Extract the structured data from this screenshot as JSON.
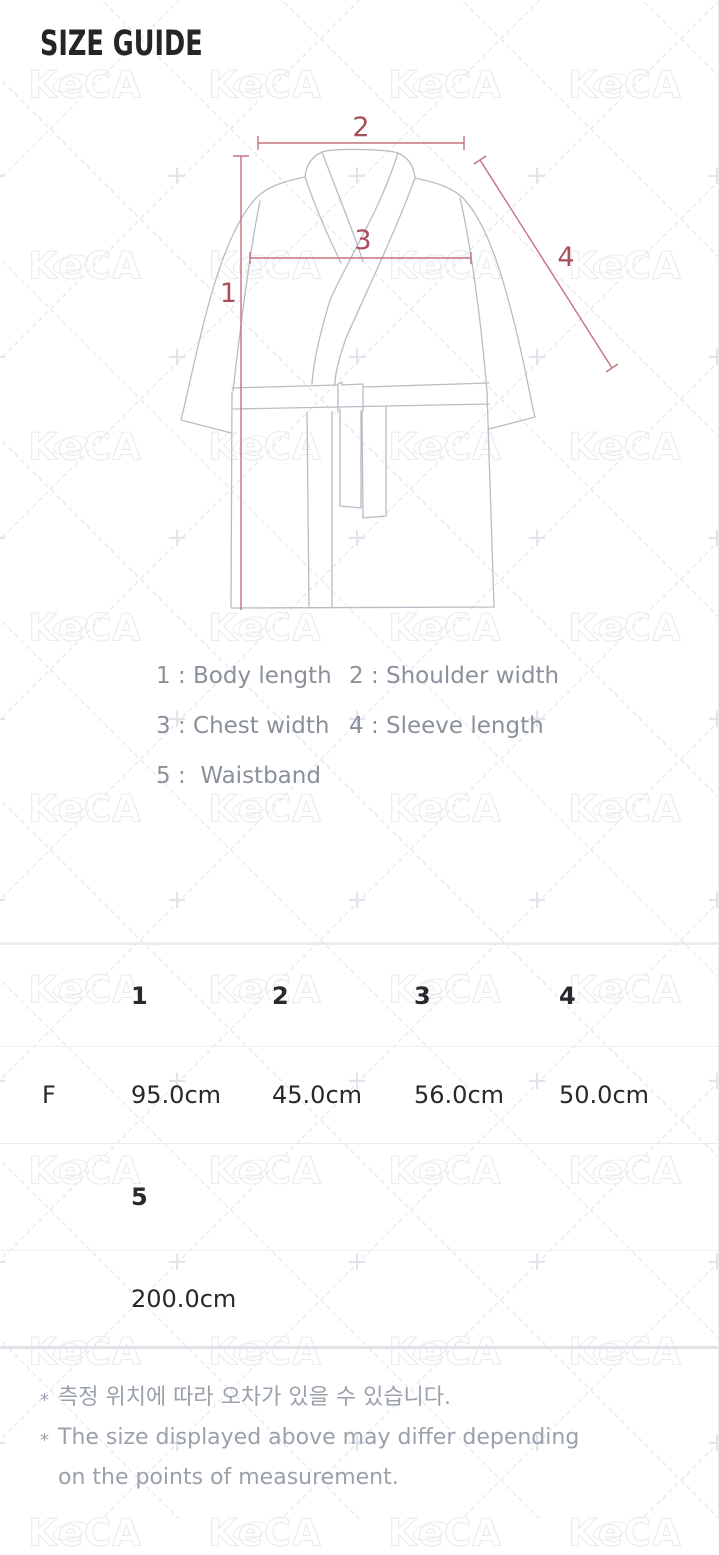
{
  "page": {
    "title": "SIZE GUIDE"
  },
  "watermark": {
    "brand": "KeCA",
    "plus": "+"
  },
  "diagram": {
    "labels": {
      "l1": "1",
      "l2": "2",
      "l3": "3",
      "l4": "4"
    }
  },
  "legend": {
    "items": [
      "1 : Body length",
      "2 : Shoulder width",
      "3 : Chest width",
      "4 : Sleeve length",
      "5 :  Waistband"
    ]
  },
  "size_table": {
    "sections": [
      {
        "headers": [
          "",
          "1",
          "2",
          "3",
          "4"
        ],
        "rows": [
          [
            "F",
            "95.0cm",
            "45.0cm",
            "56.0cm",
            "50.0cm"
          ]
        ]
      },
      {
        "headers": [
          "",
          "5"
        ],
        "rows": [
          [
            "",
            "200.0cm"
          ]
        ]
      }
    ]
  },
  "notes": [
    {
      "marker": "*",
      "lines": [
        "측정 위치에 따라 오차가 있을 수 있습니다."
      ]
    },
    {
      "marker": "*",
      "lines": [
        "The size displayed above may differ depending",
        "on the points of measurement."
      ]
    }
  ],
  "colors": {
    "measure_line": "#c2737e",
    "measure_number": "#a94f5c",
    "garment_outline": "#b7bdc6",
    "table_text": "#27292c",
    "legend_text": "#8a919b",
    "note_text": "#9aa1ab",
    "watermark": "#e9ebf0"
  }
}
